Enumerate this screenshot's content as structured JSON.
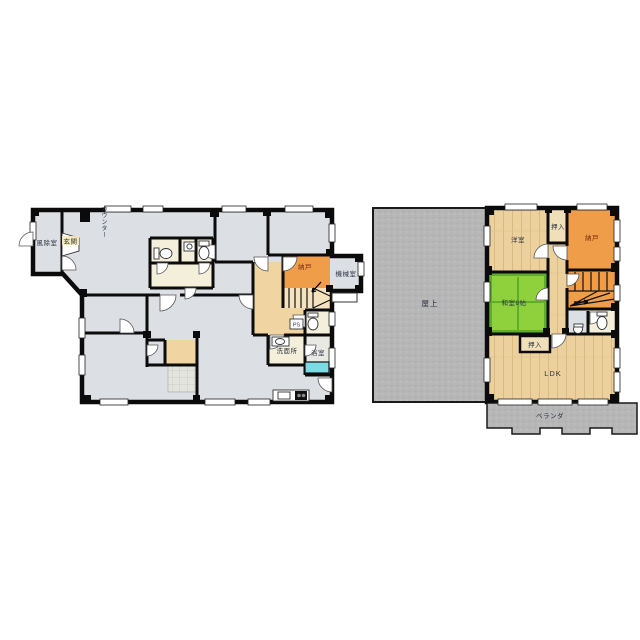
{
  "floor1": {
    "labels": {
      "windbreak_room": "風除室",
      "entrance": "玄関",
      "counter": "カウンター",
      "storage": "納戸",
      "machine_room": "機械室",
      "washroom": "洗面所",
      "bathroom": "浴室",
      "pipe_space": "PS"
    }
  },
  "floor2": {
    "labels": {
      "rooftop": "屋上",
      "western_room": "洋室",
      "closet_top": "押入",
      "storage": "納戸",
      "japanese_room": "和室8帖",
      "closet_bottom": "押入",
      "ldk": "LDK",
      "veranda": "ベランダ"
    }
  },
  "colors": {
    "floor_gray": "#dcdfe3",
    "concrete_gray": "#b6b6b6",
    "storage_orange": "#ef9d49",
    "wood_tan": "#ecd19e",
    "hall_tan": "#f0d5a2",
    "closet_tan": "#f1dfb9",
    "tatami_green": "#8ed13c",
    "tatami_edge_green": "#5fae2a",
    "cream": "#f3efdb",
    "bathtub_cyan": "#7adde6",
    "wall_black": "#0b0b0b"
  }
}
